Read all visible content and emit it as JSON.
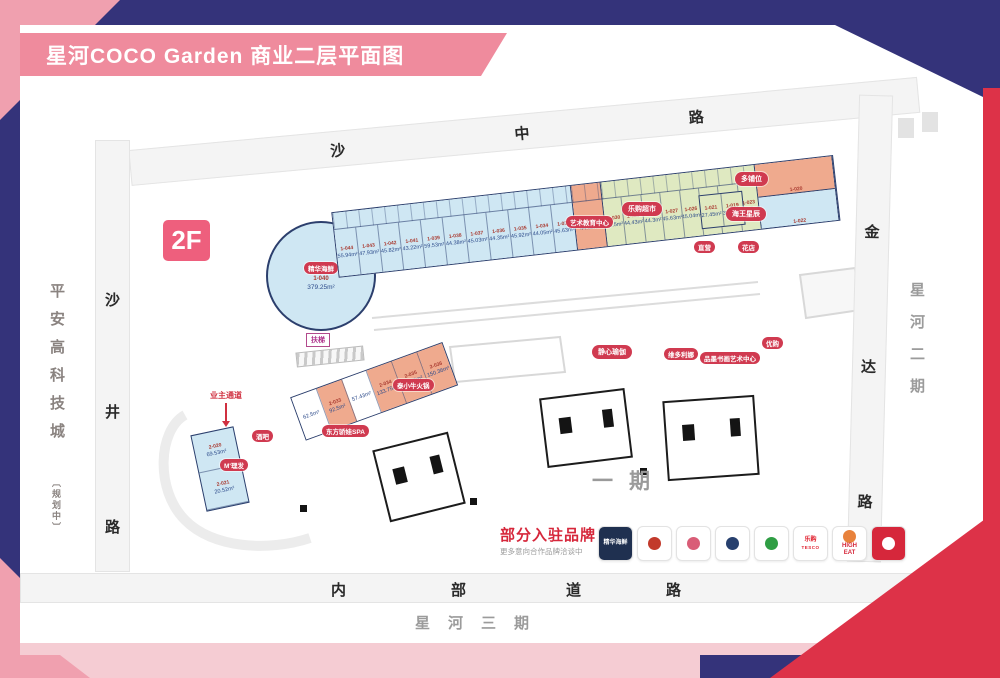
{
  "header": {
    "title": "星河COCO Garden 商业二层平面图",
    "floor_badge": "2F"
  },
  "roads": {
    "top": {
      "chars": [
        "沙",
        "中",
        "路"
      ]
    },
    "left": {
      "chars": [
        "沙",
        "井",
        "路"
      ]
    },
    "right": {
      "chars": [
        "金",
        "达",
        "路"
      ]
    },
    "bottom": {
      "chars": [
        "内",
        "部",
        "道",
        "路"
      ]
    }
  },
  "districts": {
    "left": "平安高科技城",
    "left_note": "〔规划中〕",
    "right": "星河二期",
    "bottom": "星河三期",
    "phase": "一期"
  },
  "plan": {
    "circle": {
      "name": "精华海鲜",
      "no": "1-040",
      "area": "379.25m²"
    },
    "slab_a": {
      "blue_units": [
        {
          "no": "1-044",
          "area": "55.94m²"
        },
        {
          "no": "1-043",
          "area": "47.93m²"
        },
        {
          "no": "1-042",
          "area": "45.82m²"
        },
        {
          "no": "1-041",
          "area": "43.22m²"
        },
        {
          "no": "1-039",
          "area": "59.53m²"
        },
        {
          "no": "1-038",
          "area": "44.38m²"
        },
        {
          "no": "1-037",
          "area": "45.03m²"
        },
        {
          "no": "1-036",
          "area": "44.35m²"
        },
        {
          "no": "1-035",
          "area": "45.92m²"
        },
        {
          "no": "1-034",
          "area": "44.05m²"
        },
        {
          "no": "1-033",
          "area": "45.63m²"
        }
      ],
      "edu_unit": {
        "label": "艺术教育中心",
        "no": "1-031",
        "area": "44.35m²"
      },
      "green_units": [
        {
          "no": "1-030",
          "area": "45.5m²"
        },
        {
          "no": "1-029",
          "area": "44.43m²"
        },
        {
          "no": "1-028",
          "area": "44.3m²"
        },
        {
          "no": "1-027",
          "area": "45.63m²"
        },
        {
          "no": "1-026",
          "area": "45.04m²"
        },
        {
          "no": "1-025",
          "area": "45.75m²"
        },
        {
          "no": "1-024",
          "area": "43.29m²"
        },
        {
          "no": "1-023",
          "area": "44.25m²"
        }
      ],
      "right_small": [
        {
          "no": "1-021",
          "area": "27.45m²"
        },
        {
          "no": "1-019",
          "area": "34.63m²"
        }
      ],
      "right_top_no": "1-020",
      "right_bottom_no": "1-022",
      "labels": {
        "supermarket": "乐购超市",
        "multi": "多铺位",
        "pharmacy": "海王星辰",
        "direct": "直营",
        "flower": "花店"
      }
    },
    "row_b": {
      "units": [
        {
          "no": "2-010",
          "area": "134.66m²",
          "bg": "#cfe7f3"
        },
        {
          "no": "2-009",
          "area": "54.47m²",
          "bg": "#cfe7f3"
        },
        {
          "no": "2-008",
          "area": "98.65m²",
          "bg": "#cfe7f3"
        },
        {
          "no": "2-007",
          "area": "107.53m²",
          "bg": "#cfe7f3"
        },
        {
          "no": "2-006",
          "area": "107.83m²",
          "bg": "#cfe7f3"
        },
        {
          "no": "2-005",
          "area": "98.43m²",
          "bg": "#dfe9c1"
        },
        {
          "no": "2-004",
          "area": "53.92m²",
          "bg": "#dfe9c1"
        },
        {
          "no": "2-003",
          "area": "105.26m²",
          "bg": "#efaa8e"
        },
        {
          "no": "2-002",
          "area": "94.58m²",
          "bg": "#efaa8e"
        },
        {
          "no": "2-001",
          "area": "93.02m²",
          "bg": "#efaa8e"
        }
      ],
      "labels": {
        "yoga": "静心瑜伽",
        "victoria": "维多利娜",
        "art": "品墨书画艺术中心",
        "yougou": "优购"
      }
    },
    "strip_c": {
      "units": [
        {
          "no": "",
          "area": "62.5m²",
          "bg": "#ffffff"
        },
        {
          "no": "2-033",
          "area": "92.5m²",
          "bg": "#efaa8e"
        },
        {
          "no": "",
          "area": "57.43m²",
          "bg": "#ffffff"
        },
        {
          "no": "2-034",
          "area": "133.75m²",
          "bg": "#efaa8e"
        },
        {
          "no": "2-035",
          "area": "94.46m²",
          "bg": "#efaa8e"
        },
        {
          "no": "2-036",
          "area": "150.36m²",
          "bg": "#efaa8e"
        }
      ],
      "labels": {
        "thai": "泰小牛火锅",
        "spa": "东方骄娃SPA",
        "bar": "酒吧",
        "barber": "M'理发"
      },
      "owner_passage": "业主通道"
    },
    "mini": {
      "units": [
        {
          "no": "2-020",
          "area": "69.53m²"
        },
        {
          "no": "2-021",
          "area": "20.52m²"
        }
      ]
    },
    "escalator": "扶梯"
  },
  "brands": {
    "heading": "部分入驻品牌",
    "subheading": "更多意向合作品牌洽谈中",
    "items": [
      {
        "label": "精华海鲜",
        "bg": "#1f3050",
        "fg": "#ffffff"
      },
      {
        "glyph": "#c23a2b"
      },
      {
        "glyph": "#d95d77"
      },
      {
        "glyph": "#27406e"
      },
      {
        "glyph": "#2f9e44"
      },
      {
        "label": "乐购",
        "sub": "TESCO",
        "fg": "#e01f2d"
      },
      {
        "label": "HIGH EAT",
        "glyph": "#e8823c",
        "fg": "#d6273b"
      },
      {
        "glyph": "#ffffff",
        "bg": "#d6273b"
      }
    ]
  },
  "colors": {
    "frame_navy": "#34337a",
    "banner_pink": "#ef8b9d",
    "accent_red": "#dd3248",
    "pill_red": "#d03a50",
    "unit_blue": "#cfe7f3",
    "unit_green": "#dfe9c1",
    "unit_orange": "#efaa8e"
  }
}
